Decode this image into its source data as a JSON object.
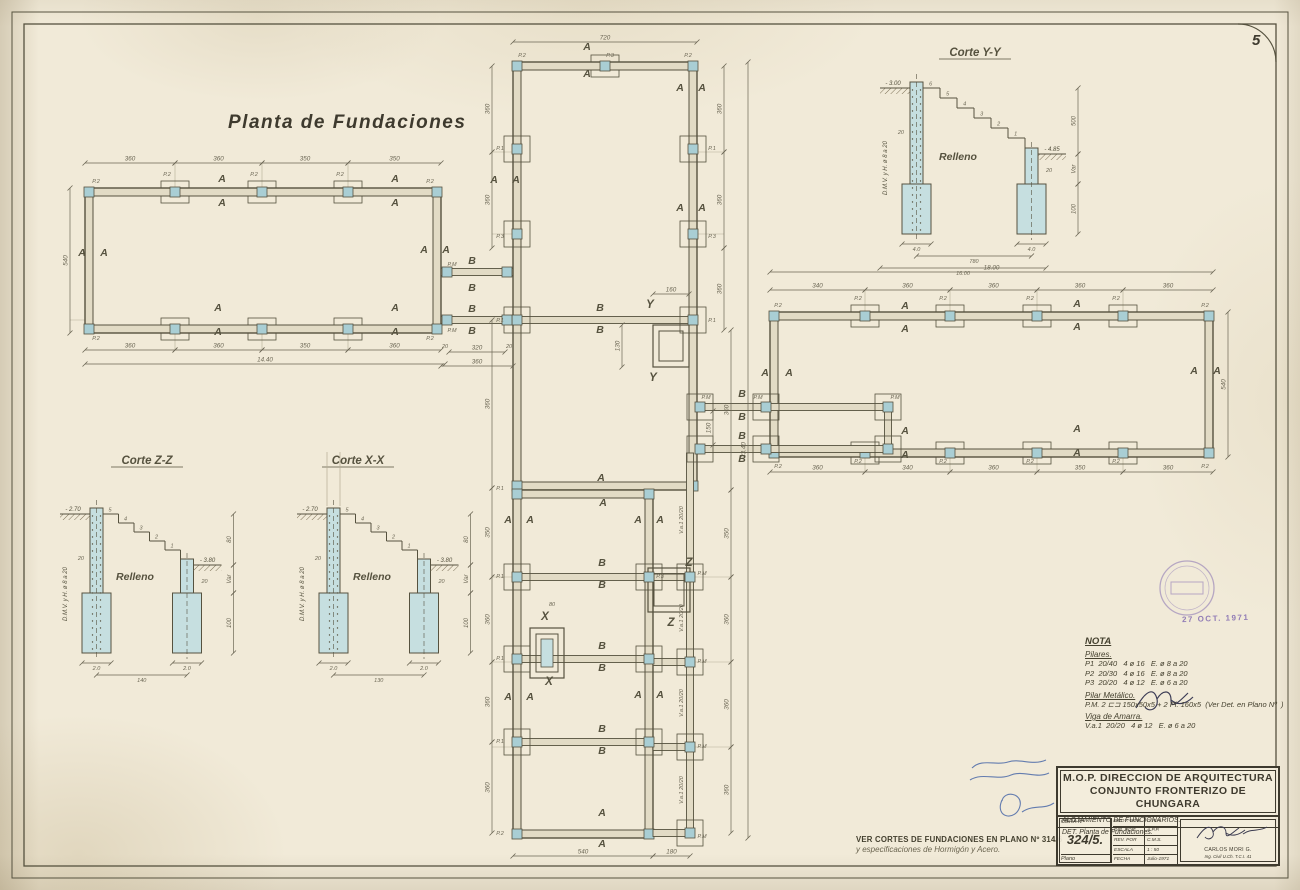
{
  "style": {
    "paper": "#f1ead8",
    "line": "#56523f",
    "line_light": "#b5ad96",
    "wall_fill": "#e2dbc5",
    "blue": "#a9ced4",
    "blue_light": "#c6dfe0",
    "stamp": "#7b63ae",
    "ink_blue": "#4a68a8",
    "dim_col": "#6b6654"
  },
  "sheet": {
    "page_number": "5",
    "margin_code": "15495"
  },
  "plan": {
    "title": "Planta de Fundaciones",
    "wings": [
      {
        "x": 85,
        "y": 188,
        "w": 356,
        "h": 145,
        "t": 8,
        "cols_top": [
          175,
          262,
          348
        ],
        "cols_bottom": [
          175,
          262,
          348
        ]
      },
      {
        "x": 770,
        "y": 312,
        "w": 443,
        "h": 145,
        "t": 8,
        "cols_top": [
          865,
          950,
          1037,
          1123
        ],
        "cols_bottom": [
          865,
          950,
          1037,
          1123
        ]
      },
      {
        "x": 513,
        "y": 62,
        "w": 184,
        "h": 428,
        "t": 8,
        "cols_top": [
          605
        ],
        "cols_bottom": []
      },
      {
        "x": 513,
        "y": 490,
        "w": 140,
        "h": 348,
        "t": 8,
        "cols_top": [],
        "cols_bottom": []
      }
    ],
    "beams_h": [
      [
        441,
        513,
        272
      ],
      [
        441,
        689,
        320
      ],
      [
        521,
        645,
        577
      ],
      [
        521,
        645,
        659
      ],
      [
        521,
        645,
        742
      ],
      [
        697,
        888,
        407
      ],
      [
        697,
        888,
        449
      ],
      [
        653,
        686,
        577
      ],
      [
        653,
        686,
        662
      ],
      [
        653,
        686,
        747
      ],
      [
        653,
        686,
        833
      ]
    ],
    "beams_v": [
      [
        690,
        453,
        833
      ],
      [
        888,
        403,
        453
      ]
    ],
    "rooms": [
      {
        "x": 653,
        "y": 325,
        "w": 36,
        "h": 42
      },
      {
        "x": 648,
        "y": 568,
        "w": 42,
        "h": 44
      }
    ],
    "x_detail": {
      "x": 530,
      "y": 628,
      "w": 34,
      "h": 50
    },
    "footings_sq": [
      [
        517,
        149
      ],
      [
        517,
        234
      ],
      [
        693,
        149
      ],
      [
        693,
        234
      ],
      [
        517,
        320
      ],
      [
        693,
        320
      ],
      [
        517,
        577
      ],
      [
        517,
        659
      ],
      [
        517,
        742
      ],
      [
        649,
        577
      ],
      [
        649,
        659
      ],
      [
        649,
        742
      ],
      [
        690,
        577
      ],
      [
        690,
        662
      ],
      [
        690,
        747
      ],
      [
        690,
        833
      ],
      [
        700,
        407
      ],
      [
        766,
        407
      ],
      [
        700,
        449
      ],
      [
        766,
        449
      ],
      [
        888,
        407
      ],
      [
        888,
        449
      ]
    ],
    "cols_pt": [
      [
        447,
        272
      ],
      [
        507,
        272
      ],
      [
        447,
        320
      ],
      [
        507,
        320
      ]
    ],
    "axes": {
      "h": [
        [
          492,
          724,
          152
        ],
        [
          492,
          724,
          234
        ],
        [
          70,
          492,
          320
        ],
        [
          492,
          731,
          577
        ],
        [
          492,
          731,
          662
        ],
        [
          492,
          731,
          747
        ]
      ],
      "v": [
        [
          175,
          163,
          350
        ],
        [
          262,
          163,
          350
        ],
        [
          348,
          163,
          350
        ],
        [
          865,
          290,
          472
        ],
        [
          950,
          290,
          472
        ],
        [
          1037,
          290,
          472
        ],
        [
          1123,
          290,
          472
        ]
      ]
    },
    "letters": [
      {
        "t": "A",
        "pts": [
          [
            222,
            182
          ],
          [
            222,
            206
          ],
          [
            395,
            182
          ],
          [
            395,
            206
          ],
          [
            82,
            256
          ],
          [
            104,
            256
          ],
          [
            424,
            253
          ],
          [
            446,
            253
          ],
          [
            218,
            311
          ],
          [
            218,
            335
          ],
          [
            395,
            311
          ],
          [
            395,
            335
          ],
          [
            587,
            50
          ],
          [
            587,
            77
          ],
          [
            494,
            183
          ],
          [
            516,
            183
          ],
          [
            680,
            91
          ],
          [
            702,
            91
          ],
          [
            680,
            211
          ],
          [
            702,
            211
          ],
          [
            601,
            481
          ],
          [
            603,
            506
          ],
          [
            508,
            523
          ],
          [
            530,
            523
          ],
          [
            638,
            523
          ],
          [
            660,
            523
          ],
          [
            508,
            700
          ],
          [
            530,
            700
          ],
          [
            638,
            698
          ],
          [
            660,
            698
          ],
          [
            602,
            816
          ],
          [
            602,
            847
          ],
          [
            905,
            309
          ],
          [
            905,
            332
          ],
          [
            1077,
            307
          ],
          [
            1077,
            330
          ],
          [
            905,
            434
          ],
          [
            905,
            458
          ],
          [
            1077,
            432
          ],
          [
            1077,
            456
          ],
          [
            765,
            376
          ],
          [
            789,
            376
          ],
          [
            1194,
            374
          ],
          [
            1217,
            374
          ]
        ]
      },
      {
        "t": "B",
        "pts": [
          [
            600,
            311
          ],
          [
            600,
            333
          ],
          [
            602,
            566
          ],
          [
            602,
            588
          ],
          [
            602,
            649
          ],
          [
            602,
            671
          ],
          [
            602,
            732
          ],
          [
            602,
            754
          ],
          [
            472,
            264
          ],
          [
            472,
            291
          ],
          [
            472,
            312
          ],
          [
            472,
            334
          ],
          [
            742,
            397
          ],
          [
            742,
            420
          ],
          [
            742,
            439
          ],
          [
            742,
            462
          ]
        ]
      }
    ],
    "plabels": [
      {
        "t": "P.2",
        "pts": [
          [
            96,
            183
          ],
          [
            430,
            183
          ],
          [
            96,
            340
          ],
          [
            430,
            340
          ],
          [
            167,
            176
          ],
          [
            254,
            176
          ],
          [
            340,
            176
          ],
          [
            522,
            57
          ],
          [
            688,
            57
          ],
          [
            778,
            307
          ],
          [
            1205,
            307
          ],
          [
            778,
            468
          ],
          [
            1205,
            468
          ],
          [
            858,
            300
          ],
          [
            943,
            300
          ],
          [
            1030,
            300
          ],
          [
            1116,
            300
          ],
          [
            858,
            463
          ],
          [
            943,
            463
          ],
          [
            1030,
            463
          ],
          [
            1116,
            463
          ],
          [
            500,
            835
          ]
        ]
      },
      {
        "t": "P.1",
        "pts": [
          [
            500,
            150
          ],
          [
            712,
            150
          ],
          [
            500,
            322
          ],
          [
            500,
            490
          ],
          [
            500,
            578
          ],
          [
            500,
            660
          ],
          [
            500,
            743
          ],
          [
            712,
            322
          ]
        ]
      },
      {
        "t": "P.3",
        "pts": [
          [
            610,
            57
          ],
          [
            500,
            238
          ],
          [
            712,
            238
          ],
          [
            660,
            578
          ]
        ]
      },
      {
        "t": "P.M",
        "pts": [
          [
            452,
            266
          ],
          [
            452,
            332
          ],
          [
            706,
            399
          ],
          [
            758,
            399
          ],
          [
            895,
            399
          ],
          [
            702,
            575
          ],
          [
            702,
            663
          ],
          [
            702,
            748
          ],
          [
            702,
            838
          ]
        ]
      }
    ],
    "cuts": [
      {
        "t": "Y",
        "pts": [
          [
            650,
            308
          ],
          [
            653,
            381
          ]
        ]
      },
      {
        "t": "Z",
        "pts": [
          [
            689,
            566
          ],
          [
            671,
            626
          ]
        ]
      },
      {
        "t": "X",
        "pts": [
          [
            545,
            620
          ],
          [
            549,
            685
          ]
        ]
      }
    ],
    "va_text": "V.a.1 20/20",
    "va_labels": [
      [
        683,
        520
      ],
      [
        683,
        618
      ],
      [
        683,
        703
      ],
      [
        683,
        790
      ]
    ],
    "tiny": [
      {
        "t": "20",
        "x": 445,
        "y": 348
      },
      {
        "t": "20",
        "x": 509,
        "y": 348
      },
      {
        "t": "80",
        "x": 552,
        "y": 606
      }
    ],
    "dims": [
      [
        "h",
        85,
        175,
        163,
        "360"
      ],
      [
        "h",
        175,
        262,
        163,
        "360"
      ],
      [
        "h",
        262,
        348,
        163,
        "350"
      ],
      [
        "h",
        348,
        441,
        163,
        "350"
      ],
      [
        "h",
        85,
        175,
        350,
        "360"
      ],
      [
        "h",
        175,
        262,
        350,
        "360"
      ],
      [
        "h",
        262,
        348,
        350,
        "350"
      ],
      [
        "h",
        348,
        441,
        350,
        "360"
      ],
      [
        "h",
        85,
        445,
        364,
        "14.40"
      ],
      [
        "v",
        188,
        333,
        70,
        "540"
      ],
      [
        "h",
        449,
        505,
        352,
        "320"
      ],
      [
        "h",
        441,
        513,
        366,
        "360"
      ],
      [
        "h",
        513,
        697,
        42,
        "720"
      ],
      [
        "v",
        66,
        152,
        724,
        "360"
      ],
      [
        "v",
        152,
        248,
        724,
        "360"
      ],
      [
        "v",
        248,
        330,
        724,
        "360"
      ],
      [
        "v",
        66,
        152,
        492,
        "360"
      ],
      [
        "v",
        152,
        248,
        492,
        "360"
      ],
      [
        "v",
        320,
        488,
        492,
        "360"
      ],
      [
        "v",
        488,
        577,
        492,
        "350"
      ],
      [
        "v",
        577,
        662,
        492,
        "360"
      ],
      [
        "v",
        662,
        742,
        492,
        "360"
      ],
      [
        "v",
        742,
        833,
        492,
        "360"
      ],
      [
        "v",
        330,
        490,
        731,
        "360"
      ],
      [
        "v",
        490,
        577,
        731,
        "350"
      ],
      [
        "v",
        577,
        662,
        731,
        "360"
      ],
      [
        "v",
        662,
        747,
        731,
        "360"
      ],
      [
        "v",
        747,
        833,
        731,
        "360"
      ],
      [
        "v",
        62,
        838,
        748,
        "33.40"
      ],
      [
        "v",
        411,
        445,
        713,
        "150"
      ],
      [
        "h",
        513,
        653,
        856,
        "540"
      ],
      [
        "h",
        653,
        690,
        856,
        "180"
      ],
      [
        "h",
        653,
        689,
        294,
        "160"
      ],
      [
        "v",
        325,
        367,
        622,
        "130"
      ],
      [
        "h",
        770,
        1213,
        272,
        "18.00"
      ],
      [
        "h",
        770,
        865,
        290,
        "340"
      ],
      [
        "h",
        865,
        950,
        290,
        "360"
      ],
      [
        "h",
        950,
        1037,
        290,
        "360"
      ],
      [
        "h",
        1037,
        1123,
        290,
        "360"
      ],
      [
        "h",
        1123,
        1213,
        290,
        "360"
      ],
      [
        "h",
        770,
        865,
        472,
        "360"
      ],
      [
        "h",
        865,
        950,
        472,
        "340"
      ],
      [
        "h",
        950,
        1037,
        472,
        "360"
      ],
      [
        "h",
        1037,
        1123,
        472,
        "350"
      ],
      [
        "h",
        1123,
        1213,
        472,
        "360"
      ],
      [
        "v",
        312,
        457,
        1228,
        "540"
      ]
    ]
  },
  "sections": [
    {
      "title": "Corte Y-Y",
      "x": 880,
      "y": 56,
      "tx": 95,
      "gdrop": 32,
      "stemH": 152,
      "footH": 50,
      "dx": 17,
      "dy": 10,
      "steps": [
        "6",
        "5",
        "4",
        "3",
        "2",
        "1"
      ],
      "elev_top": "- 3.00",
      "elev_mid": "- 4.85",
      "wall_dim": "20",
      "wall_dim2": "20",
      "relleno": "Relleno",
      "rebar": "D.M.V. y H. ø 8 a 20",
      "foot_l": "4.0",
      "foot_r": "4.0",
      "span": "780",
      "total": "16.00",
      "right_dims": [
        "500",
        "Var",
        "100"
      ],
      "relx": 78,
      "rely": 72,
      "stub": false
    },
    {
      "title": "Corte Z-Z",
      "x": 60,
      "y": 464,
      "tx": 87,
      "gdrop": 50,
      "stemH": 145,
      "footH": 60,
      "dx": 15.5,
      "dy": 9,
      "steps": [
        "5",
        "4",
        "3",
        "2",
        "1"
      ],
      "elev_top": "- 2.70",
      "elev_mid": "- 3.80",
      "wall_dim": "20",
      "wall_dim2": "20",
      "relleno": "Relleno",
      "rebar": "D.M.V. y H. ø 8 a 20",
      "foot_l": "2.0",
      "foot_r": "2.0",
      "span": "140",
      "total": "",
      "right_dims": [
        "80",
        "Var",
        "100"
      ],
      "relx": 75,
      "rely": 66,
      "stub": false
    },
    {
      "title": "Corte X-X",
      "x": 297,
      "y": 464,
      "tx": 61,
      "gdrop": 50,
      "stemH": 145,
      "footH": 60,
      "dx": 15.5,
      "dy": 9,
      "steps": [
        "5",
        "4",
        "3",
        "2",
        "1"
      ],
      "elev_top": "- 2.70",
      "elev_mid": "- 3.80",
      "wall_dim": "20",
      "wall_dim2": "20",
      "relleno": "Relleno",
      "rebar": "D.M.V. y H. ø 8 a 20",
      "foot_l": "2.0",
      "foot_r": "2.0",
      "span": "130",
      "total": "",
      "right_dims": [
        "80",
        "Var",
        "100"
      ],
      "relx": 75,
      "rely": 66,
      "stub": true
    }
  ],
  "nota": {
    "heading": "NOTA",
    "groups": [
      {
        "title": "Pilares.",
        "lines": [
          "P1  20/40   4 ø 16   E. ø 8 a 20",
          "P2  20/30   4 ø 16   E. ø 8 a 20",
          "P3  20/20   4 ø 12   E. ø 6 a 20"
        ]
      },
      {
        "title": "Pilar Metálico.",
        "lines": [
          "P.M. 2 ⊏⊐ 150x50x5 + 2 Pl. 160x5  (Ver Det. en Plano Nº  )"
        ]
      },
      {
        "title": "Viga de Amarra.",
        "lines": [
          "V.a.1  20/20   4 ø 12   E. ø 6 a 20"
        ]
      }
    ]
  },
  "footer_note": {
    "line1": "VER CORTES DE FUNDACIONES EN PLANO Nº 314/6",
    "line2": "y especificaciones de Hormigón y Acero."
  },
  "title_block": {
    "line1": "M.O.P. DIRECCION DE ARQUITECTURA",
    "line2": "CONJUNTO FRONTERIZO DE CHUNGARA",
    "line3": "ALOJAMIENTO DE FUNCIONARIOS.",
    "line4": "DET. Planta de Fundaciones.",
    "obra_label": "OBRA Nº",
    "obra_value": "324/5.",
    "plano_label": "Plano",
    "rows": [
      {
        "label": "PROY. POR",
        "value": "G.R.R."
      },
      {
        "label": "DIB. POR",
        "value": "A.P.P."
      },
      {
        "label": "REV. POR",
        "value": "C.M.S."
      },
      {
        "label": "ESCALA",
        "value": "1 : 50"
      },
      {
        "label": "FECHA",
        "value": "Julio-1971"
      }
    ],
    "signer_name": "CARLOS MORI G.",
    "signer_title": "Ing. Civil U.Ch.   T.C.I. 41"
  },
  "stamps": {
    "date_text": "27 OCT. 1971"
  }
}
